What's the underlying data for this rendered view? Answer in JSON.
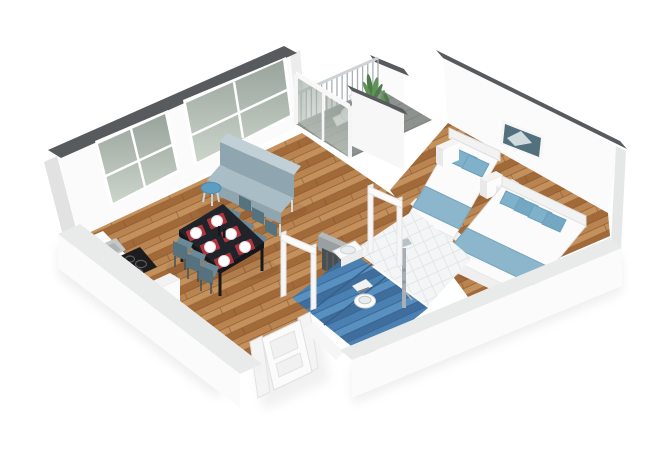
{
  "meta": {
    "type": "3d-apartment-floor-plan-render",
    "view": "isometric cutaway, white background, no visible text"
  },
  "rooms": [
    {
      "name": "living-dining-kitchen",
      "floor": "hardwood planks",
      "items": [
        "futon sofa",
        "round blue side table",
        "black dining table",
        "six place settings",
        "six teal chairs",
        "kitchen counter",
        "sink",
        "induction cooktop with four burners",
        "white cabinet",
        "two large windows"
      ]
    },
    {
      "name": "balcony",
      "floor": "gray concrete",
      "items": [
        "metal bar railing",
        "glass balustrade",
        "white outdoor table",
        "white chairs",
        "potted plants"
      ]
    },
    {
      "name": "bedroom",
      "floor": "hardwood planks",
      "items": [
        "single bed",
        "double bed",
        "blue pillows",
        "blue foot throws",
        "nightstand",
        "two dressers",
        "framed wall art"
      ]
    },
    {
      "name": "bathroom",
      "floor": "blue tile tub area + white tile shower",
      "items": [
        "wall-hung sink",
        "toilet",
        "chrome shower column",
        "gray partition",
        "dark radiator"
      ]
    },
    {
      "name": "entry",
      "items": [
        "white paneled front door"
      ]
    }
  ],
  "colors": {
    "wall_cap": "#575b5d",
    "wall_face": "#fbfbfb",
    "wall_top": "#e9eaea",
    "wood_base": "#b07a46",
    "wood_dark": "#a26939",
    "wood_mid": "#ba8450",
    "wood_light": "#c4915c",
    "wood_line": "#7e522c",
    "balcony_floor": "#8d928f",
    "balcony_line": "#7b807d",
    "tile_blue": "#4b80b2",
    "tile_blue_light": "#5890c0",
    "tile_blue_dark": "#3f6d9c",
    "tile_blue_line": "#35618e",
    "tile_white": "#f3f5f6",
    "tile_white_line": "#dde2e4",
    "glass_top": "#98a39c",
    "glass_bottom": "#ccd5ca",
    "sofa_light": "#c0d0d6",
    "sofa_mid": "#a9bdc6",
    "sofa_dark": "#8fa6b1",
    "side_table": "#5e9dc2",
    "table_black": "#202329",
    "chair_back": "#56727f",
    "chair_seat": "#6b8996",
    "placemat_red": "#b0343c",
    "plate_white": "#ffffff",
    "textile_blue": "#7fb1ca",
    "throw_blue": "#8cb6cb",
    "linen_white": "#fbfbfb",
    "plant_green": "#4e7c49",
    "plant_green_light": "#619156",
    "rail_post": "#a9afb2",
    "rail_top": "#cdd2d4",
    "chrome": "#a7afb5",
    "radiator": "#4a4f52",
    "art_blue": "#52707e"
  },
  "railing": {
    "x1": 296,
    "y1": 124,
    "x2": 378,
    "y2": 88,
    "height": 30,
    "posts": 17
  }
}
